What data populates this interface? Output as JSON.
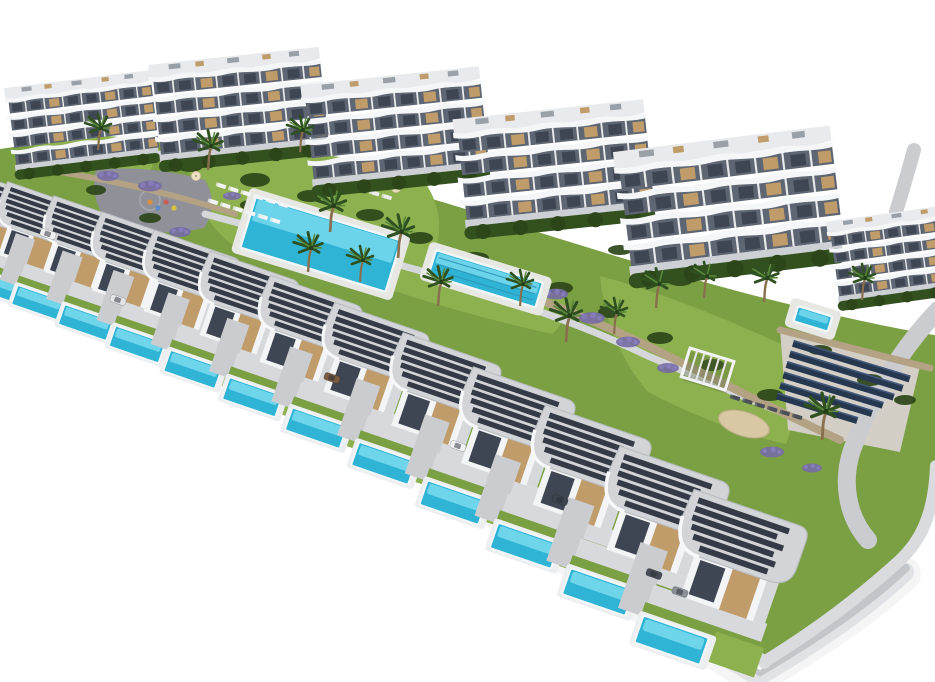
{
  "title": "Aerial 3D architectural render of a hillside residential resort: six curved white apartment blocks at the rear, a long stepped diagonal row of modern white villas with private turquoise pools in front, communal pool with sun loungers, lap pool, lawns, lavender beds, palm trees, pergola, petanque court, solar panel array and access roads, isolated on a white background",
  "palette": {
    "bg": "#ffffff",
    "lawn": "#7b9f43",
    "lawn_bright": "#8db14e",
    "green_dark": "#33511f",
    "tree": "#2c4519",
    "lavender": "#766ba4",
    "lavender_dark": "#5d5488",
    "stone": "#b3a284",
    "stone_dark": "#8d7f67",
    "ground": "#a8b07c",
    "sand": "#d8c8a4",
    "sand_pad": "#d3cfc6",
    "road": "#cbccd0",
    "plaza": "#8f9098",
    "path": "#d6d7da",
    "walk": "#d9dbde",
    "bldg_white": "#f3f4f6",
    "bldg_shadow": "#d6d9dc",
    "facade": "#5f6673",
    "glass": "#3f4653",
    "wood": "#bf9c6a",
    "roof": "#d2d4d7",
    "slat": "#343b47",
    "roofslab": "#e8eaed",
    "band": "#f4f6f8",
    "pier": "#e8eaec",
    "pool_deep": "#2fb4d6",
    "pool_light": "#85e0f2",
    "pool_rim": "#f2f6f7",
    "lane": "#2a93b4",
    "deck": "#e7e8e4",
    "solar": "#26384f",
    "solar_light": "#41587a",
    "shadow": "#7c838f",
    "trunk": "#8a6f4e",
    "frond": "#2f5020",
    "frond_light": "#5b8a3c",
    "car_white": "#eef0f2",
    "car_grey": "#8b8f96",
    "car_dark": "#464b55",
    "car_brown": "#7a5b3e",
    "hedge": "#33511f",
    "base_grey": "#cdd0d4",
    "parasol": "#ecdfc2"
  },
  "scene": {
    "apartment_buildings": [
      {
        "x": 2,
        "y": 84,
        "s": 0.72,
        "rot": -7
      },
      {
        "x": 146,
        "y": 60,
        "s": 0.84,
        "rot": -6
      },
      {
        "x": 298,
        "y": 80,
        "s": 0.88,
        "rot": -6
      },
      {
        "x": 450,
        "y": 114,
        "s": 0.94,
        "rot": -6
      },
      {
        "x": 610,
        "y": 146,
        "s": 1.07,
        "rot": -7
      },
      {
        "x": 824,
        "y": 218,
        "s": 0.7,
        "rot": -8
      }
    ],
    "villas": [
      {
        "x": -42,
        "y": 166,
        "s": 0.8,
        "rot": 19
      },
      {
        "x": 2,
        "y": 178,
        "s": 0.82,
        "rot": 19
      },
      {
        "x": 48,
        "y": 192,
        "s": 0.85,
        "rot": 19
      },
      {
        "x": 96,
        "y": 208,
        "s": 0.88,
        "rot": 19
      },
      {
        "x": 148,
        "y": 226,
        "s": 0.91,
        "rot": 19
      },
      {
        "x": 204,
        "y": 247,
        "s": 0.94,
        "rot": 19
      },
      {
        "x": 264,
        "y": 271,
        "s": 0.97,
        "rot": 19
      },
      {
        "x": 328,
        "y": 298,
        "s": 1.0,
        "rot": 19
      },
      {
        "x": 396,
        "y": 328,
        "s": 1.04,
        "rot": 19
      },
      {
        "x": 466,
        "y": 362,
        "s": 1.08,
        "rot": 19
      },
      {
        "x": 538,
        "y": 400,
        "s": 1.12,
        "rot": 19
      },
      {
        "x": 612,
        "y": 441,
        "s": 1.16,
        "rot": 19
      },
      {
        "x": 686,
        "y": 484,
        "s": 1.2,
        "rot": 19
      }
    ],
    "pools": {
      "communal": {
        "x": 256,
        "y": 196,
        "rot": 17,
        "w": 152,
        "h": 54
      },
      "lap": {
        "x": 436,
        "y": 250,
        "rot": 17,
        "w": 112,
        "h": 26,
        "lanes": 3
      },
      "terrace": {
        "x": 798,
        "y": 306,
        "rot": 17,
        "w": 36,
        "h": 16
      }
    },
    "solar_array": {
      "x": 794,
      "y": 340,
      "rot": 17,
      "row_gap": 11,
      "row_h": 7,
      "lengths": [
        122,
        118,
        112,
        104,
        96,
        84
      ]
    },
    "pergola": {
      "x": 690,
      "y": 348,
      "rot": 17,
      "w": 46,
      "h": 30,
      "slats": 5
    },
    "sand_court": {
      "x": 744,
      "y": 424,
      "rot": 17,
      "rx": 26,
      "ry": 12
    },
    "playground": {
      "x": 150,
      "y": 202,
      "dot_colors": [
        "#d98f3e",
        "#5d87c7",
        "#c75d5d",
        "#d9c33e"
      ]
    },
    "palms": [
      {
        "x": 98,
        "y": 150,
        "s": 1.0
      },
      {
        "x": 208,
        "y": 170,
        "s": 1.1
      },
      {
        "x": 300,
        "y": 152,
        "s": 1.0
      },
      {
        "x": 330,
        "y": 232,
        "s": 1.2
      },
      {
        "x": 398,
        "y": 258,
        "s": 1.2
      },
      {
        "x": 308,
        "y": 272,
        "s": 1.1
      },
      {
        "x": 360,
        "y": 282,
        "s": 1.0
      },
      {
        "x": 438,
        "y": 306,
        "s": 1.1
      },
      {
        "x": 520,
        "y": 306,
        "s": 1.0
      },
      {
        "x": 566,
        "y": 342,
        "s": 1.2
      },
      {
        "x": 614,
        "y": 334,
        "s": 1.0
      },
      {
        "x": 656,
        "y": 308,
        "s": 1.1
      },
      {
        "x": 704,
        "y": 298,
        "s": 1.0
      },
      {
        "x": 764,
        "y": 302,
        "s": 1.1
      },
      {
        "x": 822,
        "y": 440,
        "s": 1.3
      },
      {
        "x": 862,
        "y": 300,
        "s": 1.0
      }
    ],
    "bushes": [
      {
        "x": 40,
        "y": 170,
        "rx": 13,
        "ry": 6
      },
      {
        "x": 70,
        "y": 150,
        "rx": 14,
        "ry": 6
      },
      {
        "x": 130,
        "y": 158,
        "rx": 15,
        "ry": 6
      },
      {
        "x": 190,
        "y": 166,
        "rx": 13,
        "ry": 6
      },
      {
        "x": 255,
        "y": 180,
        "rx": 15,
        "ry": 7
      },
      {
        "x": 310,
        "y": 196,
        "rx": 13,
        "ry": 6
      },
      {
        "x": 250,
        "y": 205,
        "rx": 10,
        "ry": 5
      },
      {
        "x": 370,
        "y": 215,
        "rx": 14,
        "ry": 6
      },
      {
        "x": 420,
        "y": 238,
        "rx": 13,
        "ry": 6
      },
      {
        "x": 475,
        "y": 258,
        "rx": 14,
        "ry": 6
      },
      {
        "x": 560,
        "y": 288,
        "rx": 13,
        "ry": 6
      },
      {
        "x": 610,
        "y": 312,
        "rx": 12,
        "ry": 6
      },
      {
        "x": 660,
        "y": 338,
        "rx": 13,
        "ry": 6
      },
      {
        "x": 712,
        "y": 365,
        "rx": 12,
        "ry": 6
      },
      {
        "x": 770,
        "y": 395,
        "rx": 13,
        "ry": 6
      },
      {
        "x": 620,
        "y": 250,
        "rx": 12,
        "ry": 5
      },
      {
        "x": 680,
        "y": 280,
        "rx": 13,
        "ry": 6
      },
      {
        "x": 820,
        "y": 350,
        "rx": 12,
        "ry": 5
      },
      {
        "x": 870,
        "y": 380,
        "rx": 13,
        "ry": 6
      },
      {
        "x": 905,
        "y": 400,
        "rx": 11,
        "ry": 5
      },
      {
        "x": 150,
        "y": 218,
        "rx": 11,
        "ry": 5
      },
      {
        "x": 96,
        "y": 190,
        "rx": 10,
        "ry": 5
      }
    ],
    "lavender_patches": [
      {
        "x": 60,
        "y": 166,
        "s": 1.0
      },
      {
        "x": 108,
        "y": 176,
        "s": 1.1
      },
      {
        "x": 150,
        "y": 186,
        "s": 1.2
      },
      {
        "x": 180,
        "y": 232,
        "s": 1.1
      },
      {
        "x": 232,
        "y": 196,
        "s": 0.9
      },
      {
        "x": 556,
        "y": 294,
        "s": 1.2
      },
      {
        "x": 592,
        "y": 318,
        "s": 1.3
      },
      {
        "x": 628,
        "y": 342,
        "s": 1.2
      },
      {
        "x": 668,
        "y": 368,
        "s": 1.1
      },
      {
        "x": 772,
        "y": 452,
        "s": 1.2
      },
      {
        "x": 812,
        "y": 468,
        "s": 1.0
      },
      {
        "x": 700,
        "y": 520,
        "s": 1.0
      }
    ],
    "lounger_rows": [
      {
        "x": 222,
        "y": 186,
        "rot": 17,
        "n": 6,
        "color": "#f3f4f5"
      },
      {
        "x": 214,
        "y": 202,
        "rot": 17,
        "n": 6,
        "color": "#f3f4f5"
      },
      {
        "x": 338,
        "y": 182,
        "rot": 17,
        "n": 5,
        "color": "#ececed"
      },
      {
        "x": 736,
        "y": 398,
        "rot": 17,
        "n": 6,
        "color": "#4a4f58"
      }
    ],
    "parasols": [
      {
        "x": 214,
        "y": 158
      },
      {
        "x": 196,
        "y": 176
      },
      {
        "x": 344,
        "y": 170
      },
      {
        "x": 370,
        "y": 179
      },
      {
        "x": 396,
        "y": 188
      }
    ],
    "cars": [
      {
        "x": 48,
        "y": 234,
        "rot": 19,
        "color": "#eef0f2"
      },
      {
        "x": 118,
        "y": 300,
        "rot": 19,
        "color": "#e3e4e6"
      },
      {
        "x": 332,
        "y": 378,
        "rot": 19,
        "color": "#7a5b3e"
      },
      {
        "x": 458,
        "y": 446,
        "rot": 19,
        "color": "#f0f1f3"
      },
      {
        "x": 560,
        "y": 500,
        "rot": 19,
        "color": "#3f444e"
      },
      {
        "x": 654,
        "y": 574,
        "rot": 19,
        "color": "#464b55"
      },
      {
        "x": 680,
        "y": 592,
        "rot": 19,
        "color": "#8b8f96"
      }
    ]
  }
}
